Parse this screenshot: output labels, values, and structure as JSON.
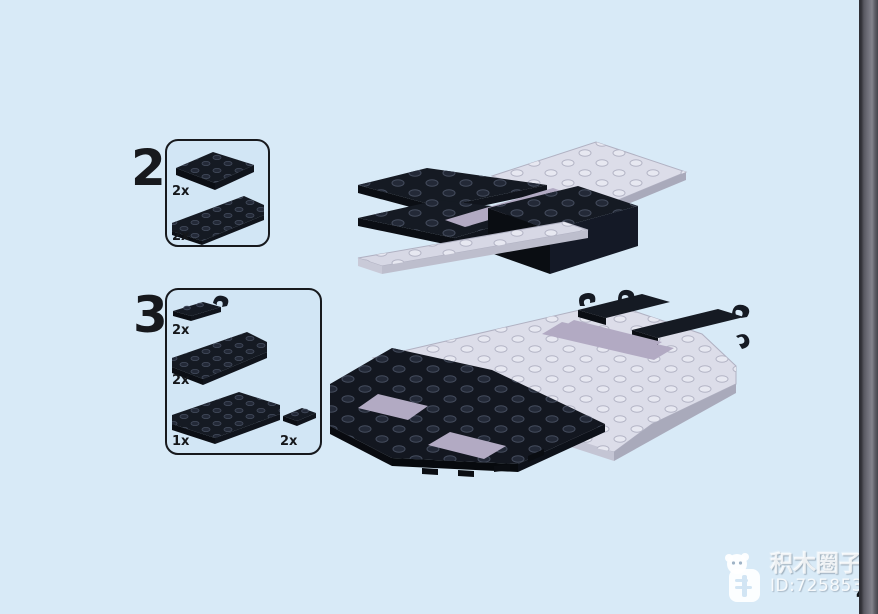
{
  "page": {
    "page_number": "4"
  },
  "steps": [
    {
      "number": "2",
      "parts": [
        {
          "name": "plate-2x4-black",
          "qty": "2x"
        },
        {
          "name": "wedge-plate-large-black",
          "qty": "2x"
        }
      ]
    },
    {
      "number": "3",
      "parts": [
        {
          "name": "plate-1x4-with-clip-black",
          "qty": "2x"
        },
        {
          "name": "wedge-plate-large-black",
          "qty": "2x"
        },
        {
          "name": "wedge-plate-medium-black",
          "qty": "1x"
        },
        {
          "name": "plate-1x2-black",
          "qty": "2x"
        }
      ]
    }
  ],
  "watermark": {
    "app_name": "积木圈子",
    "id_text": "ID:72585324"
  },
  "colors": {
    "background": "#d8eaf7",
    "callout_bg": "#d2e6f5",
    "outline": "#17191d",
    "brick_black": "#151a23",
    "brick_light": "#dcdde9",
    "brick_lavender": "#b2aac3",
    "edge_strip": "#5e5e66"
  }
}
